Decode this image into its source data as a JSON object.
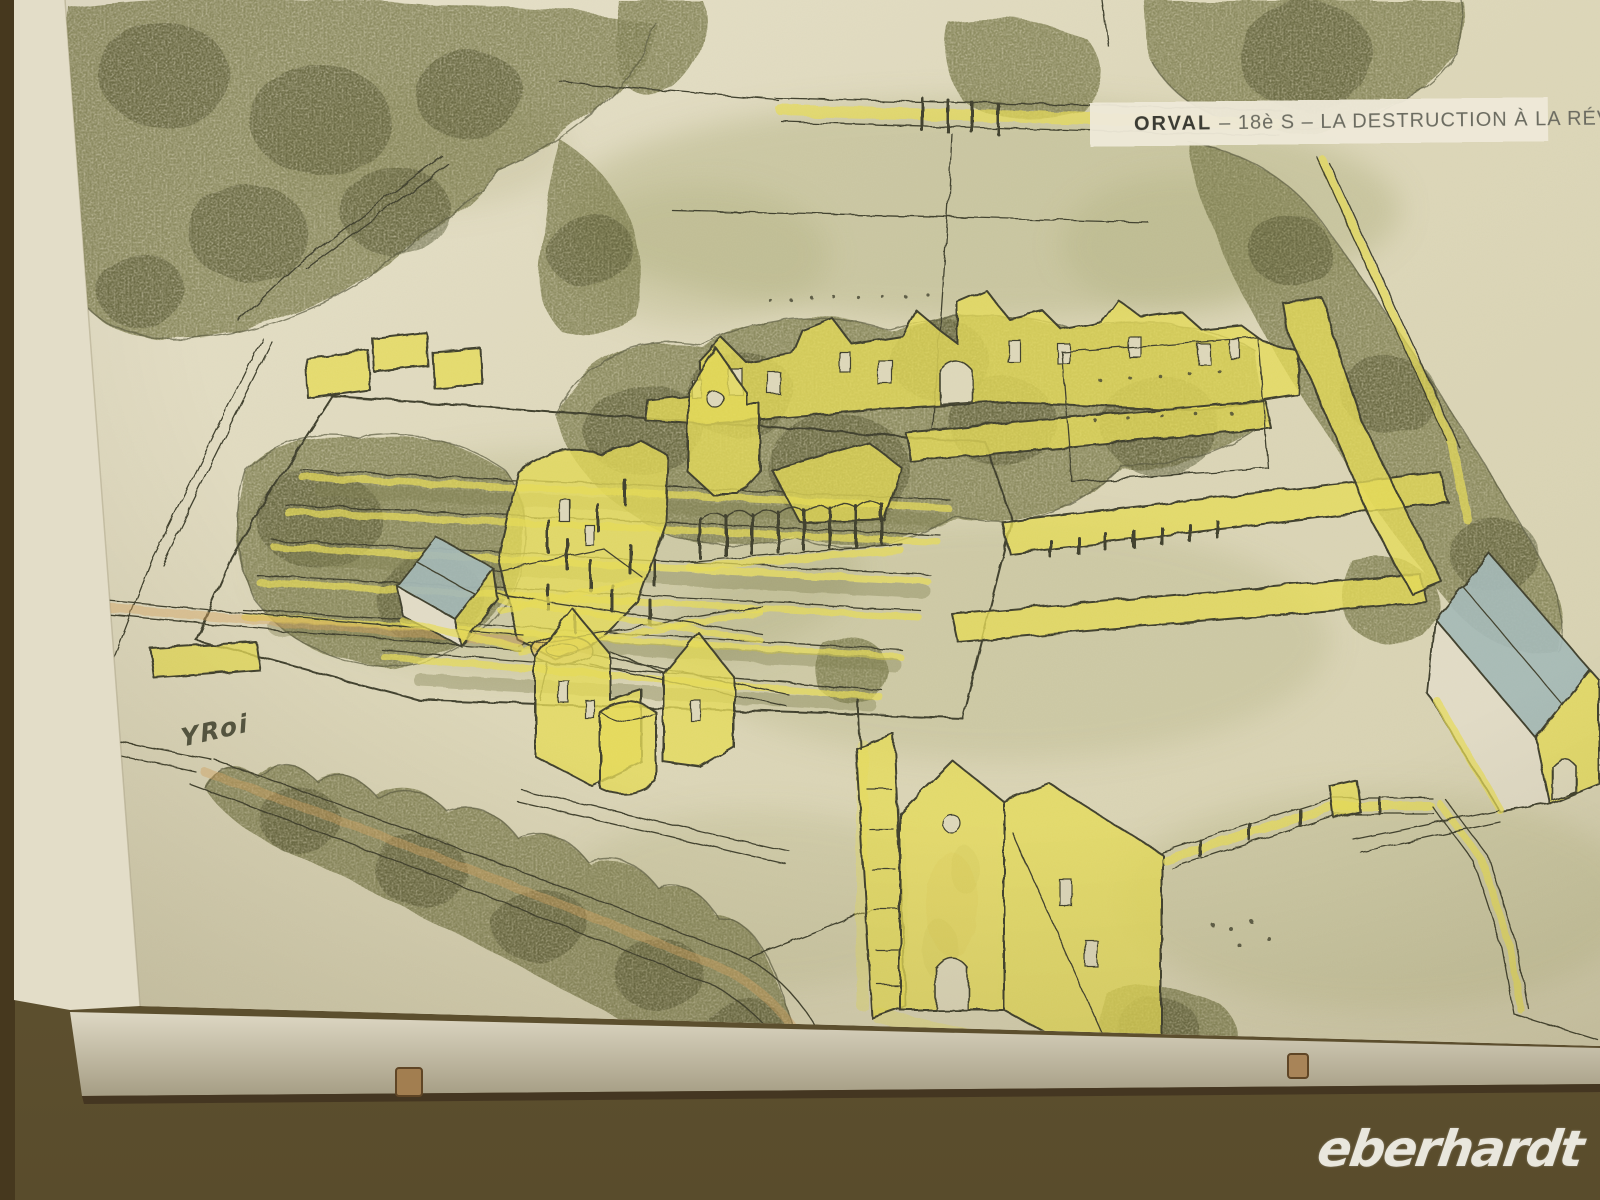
{
  "artwork": {
    "title": {
      "label": "ORVAL",
      "rest": "– 18è S – LA DESTRUCTION À LA RÉVOLUTION"
    },
    "signature": "YRoi"
  },
  "watermark": "eberhardt",
  "colors": {
    "wall": "#62552f",
    "wall_dark": "#46381e",
    "paper": "#dcd6b8",
    "paper_light": "#e7e1cc",
    "ink": "#3e3e2b",
    "yellow": "#e4da55",
    "green_light": "#aaa978",
    "green_mid": "#7b7b4d",
    "green_dark": "#51522f",
    "blue_roof": "#a3b7b5",
    "road_orange": "#d9a45e",
    "frame_edge": "#cfc8b2",
    "clip": "#a27e50",
    "title_text": "#6b6b60",
    "title_strong": "#3b3b33",
    "watermark_color": "#eceade"
  }
}
